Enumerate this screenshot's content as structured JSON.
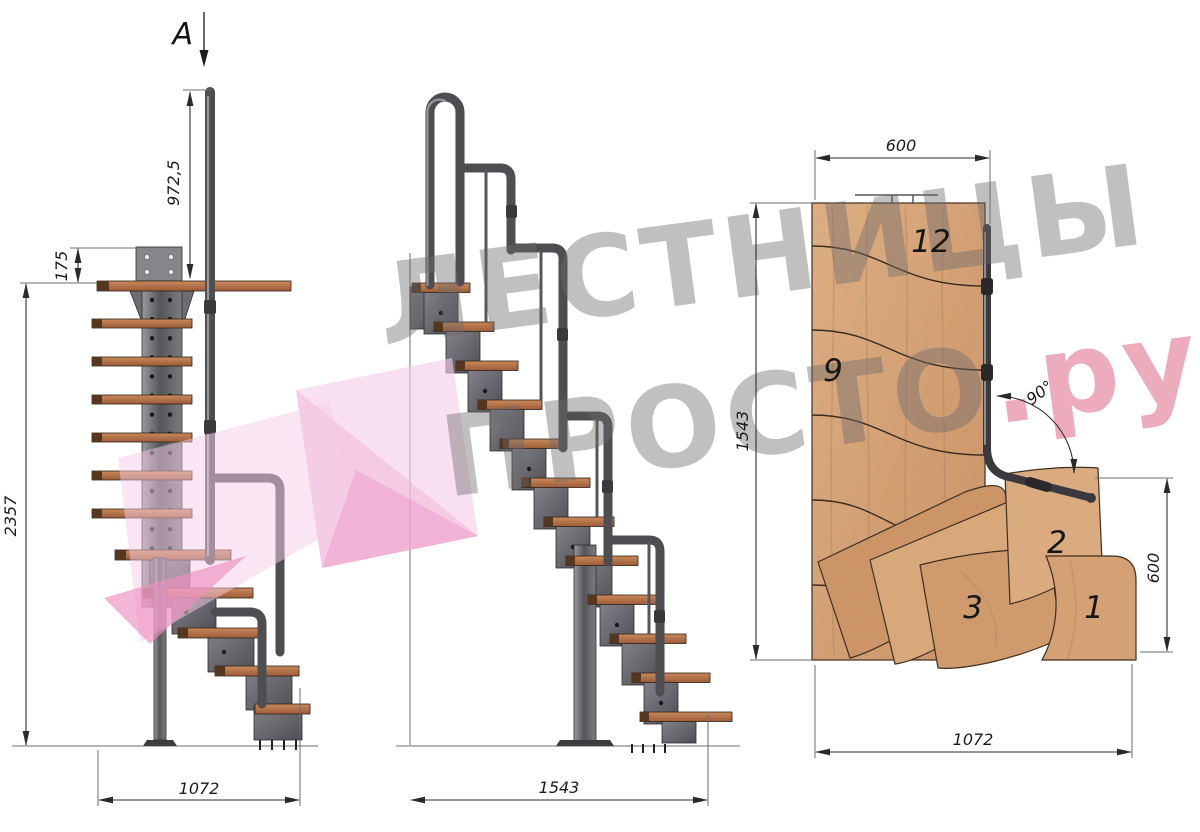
{
  "side_view": {
    "section_label": "A",
    "dim_handrail_height": "972,5",
    "dim_bracket_offset": "175",
    "dim_total_height": "2357",
    "dim_base_length": "1072"
  },
  "front_view": {
    "dim_base_length": "1543"
  },
  "plan_view": {
    "dim_top_width": "600",
    "dim_left_depth": "1543",
    "dim_right_width": "600",
    "dim_bottom_length": "1072",
    "dim_turn_angle": "90°",
    "step_labels": {
      "top": "12",
      "upper": "9",
      "second": "2",
      "third": "3",
      "first": "1"
    }
  },
  "watermark": {
    "line1": "ЛЕСТНИЦЫ",
    "line2_main": "ПРОСТО",
    "line2_accent": ".ру"
  },
  "palette": {
    "accent_pink": "#d6456f",
    "logo_pink": "#f6cde6",
    "watermark_gray": "#6b686b",
    "wood_side": "#b5714a",
    "wood_plan": "#d2a077",
    "metal": "#5a5a5e"
  }
}
